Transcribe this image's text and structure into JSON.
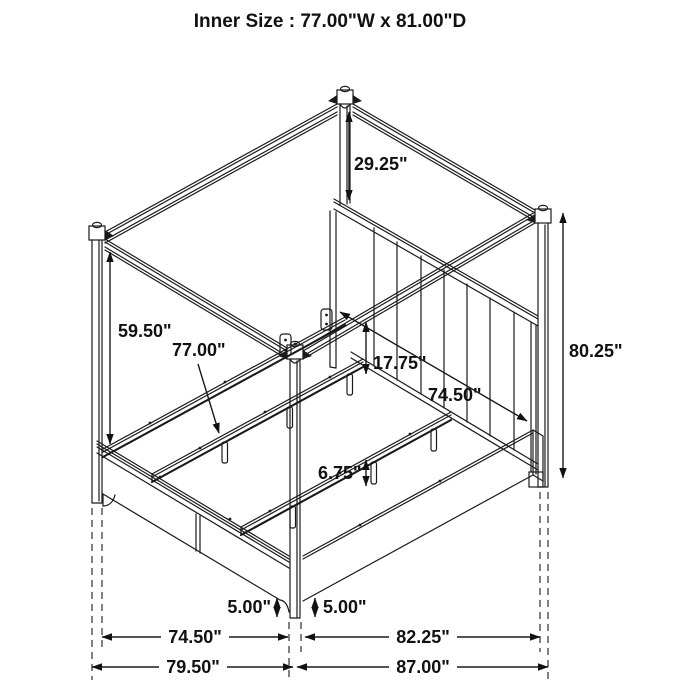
{
  "title": "Inner Size : 77.00\"W x 81.00\"D",
  "diagram": {
    "type": "furniture-dimension-diagram",
    "subject": "four-poster canopy bed, isometric wireframe line drawing",
    "dimensions": {
      "canopy_drop": "29.25\"",
      "open_height": "59.50\"",
      "inner_width": "77.00\"",
      "platform_to_canopy": "17.75\"",
      "rail_inner_length": "74.50\"",
      "overall_height": "80.25\"",
      "slat_leg_height": "6.75\"",
      "clearance_left": "5.00\"",
      "clearance_right": "5.00\"",
      "footboard_width": "74.50\"",
      "side_rail_length": "82.25\"",
      "overall_width": "79.50\"",
      "overall_depth": "87.00\""
    }
  }
}
